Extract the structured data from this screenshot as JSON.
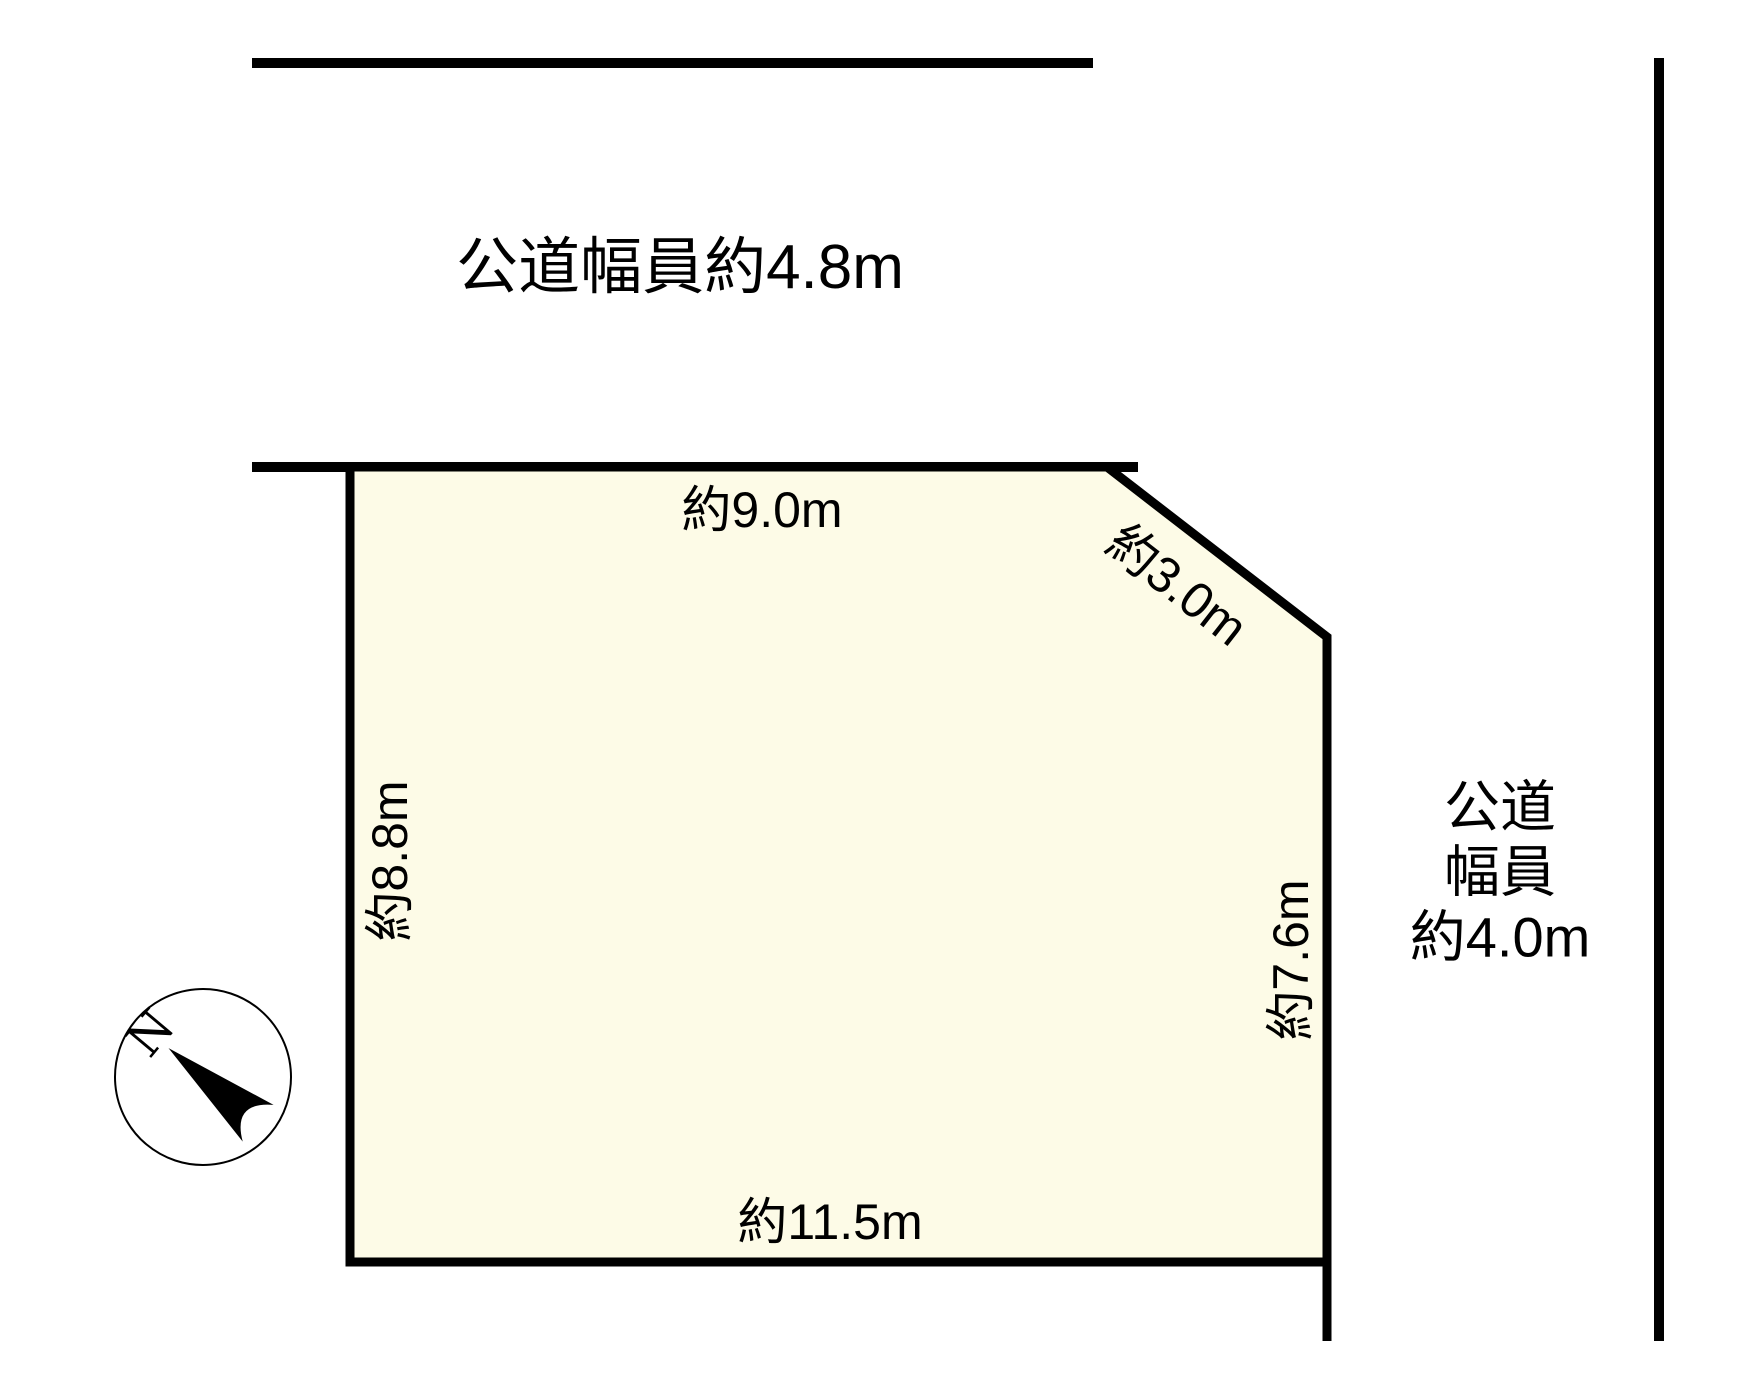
{
  "diagram": {
    "title": "land-plot-survey-diagram",
    "roads": {
      "top": {
        "label": "公道幅員約4.8m"
      },
      "right": {
        "label_lines": [
          "公道",
          "幅員",
          "約4.0m"
        ]
      }
    },
    "plot": {
      "fill_color": "#FDFBE7",
      "outline_color": "#000000",
      "dimensions": {
        "top": "約9.0m",
        "corner": "約3.0m",
        "left": "約8.8m",
        "right": "約7.6m",
        "bottom": "約11.5m"
      }
    },
    "compass": {
      "letter": "N"
    }
  }
}
